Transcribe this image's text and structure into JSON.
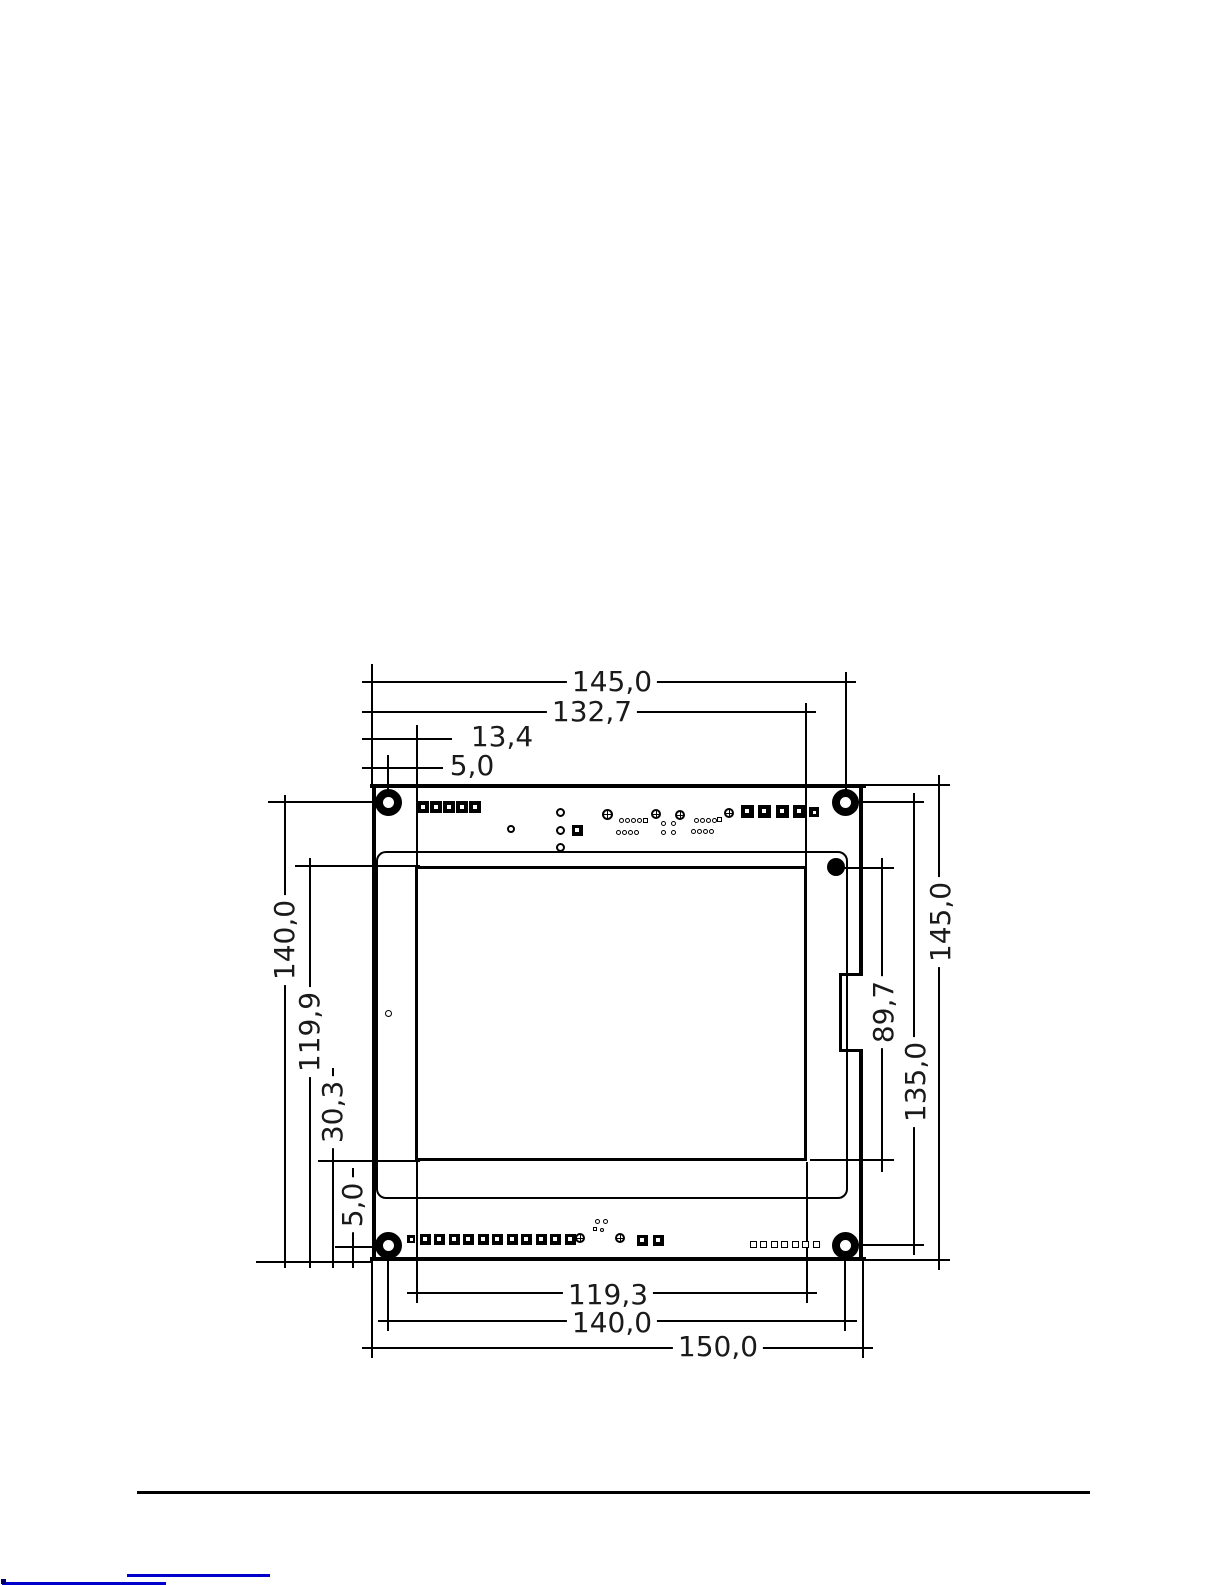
{
  "page": {
    "bg": "#ffffff",
    "ink": "#000000",
    "link_color": "#0000cc"
  },
  "diagram": {
    "type": "mechanical-dimension-drawing",
    "subject": "PCB / display module outline",
    "units": "mm",
    "dims": [
      {
        "id": "top-overall",
        "label": "145,0",
        "x": 612,
        "y": 682,
        "rot": 0
      },
      {
        "id": "top-active-right",
        "label": "132,7",
        "x": 592,
        "y": 712,
        "rot": 0
      },
      {
        "id": "top-active-left",
        "label": "13,4",
        "x": 502,
        "y": 737,
        "rot": 0
      },
      {
        "id": "top-hole-offset",
        "label": "5,0",
        "x": 472,
        "y": 766,
        "rot": 0
      },
      {
        "id": "left-hole-span",
        "label": "140,0",
        "x": 285,
        "y": 940,
        "rot": -90
      },
      {
        "id": "left-active-top",
        "label": "119,9",
        "x": 310,
        "y": 1032,
        "rot": -90
      },
      {
        "id": "left-active-bottom",
        "label": "30,3",
        "x": 333,
        "y": 1112,
        "rot": -90
      },
      {
        "id": "left-hole-offset",
        "label": "5,0",
        "x": 353,
        "y": 1205,
        "rot": -90
      },
      {
        "id": "right-active-height",
        "label": "89,7",
        "x": 884,
        "y": 1012,
        "rot": -90
      },
      {
        "id": "right-hole-span",
        "label": "135,0",
        "x": 916,
        "y": 1082,
        "rot": -90
      },
      {
        "id": "right-board-height",
        "label": "145,0",
        "x": 941,
        "y": 922,
        "rot": -90
      },
      {
        "id": "bottom-pad-span",
        "label": "119,3",
        "x": 608,
        "y": 1295,
        "rot": 0
      },
      {
        "id": "bottom-hole-span",
        "label": "140,0",
        "x": 612,
        "y": 1323,
        "rot": 0
      },
      {
        "id": "bottom-board-width",
        "label": "150,0",
        "x": 718,
        "y": 1347,
        "rot": 0
      }
    ],
    "shapes": [
      {
        "t": "h",
        "n": "board-edge-top",
        "x1": 370,
        "x2": 866,
        "y": 786,
        "w": 4
      },
      {
        "t": "h",
        "n": "board-edge-bottom",
        "x1": 370,
        "x2": 866,
        "y": 1259,
        "w": 4
      },
      {
        "t": "v",
        "n": "board-edge-left",
        "x": 374,
        "y1": 784,
        "y2": 1261,
        "w": 4
      },
      {
        "t": "v",
        "n": "board-edge-right-upper",
        "x": 861,
        "y1": 784,
        "y2": 975,
        "w": 4
      },
      {
        "t": "v",
        "n": "board-edge-right-lower",
        "x": 861,
        "y1": 1049,
        "y2": 1261,
        "w": 4
      },
      {
        "t": "h",
        "n": "board-notch-top",
        "x1": 839,
        "x2": 863,
        "y": 974,
        "w": 3
      },
      {
        "t": "h",
        "n": "board-notch-bottom",
        "x1": 839,
        "x2": 863,
        "y": 1050,
        "w": 3
      },
      {
        "t": "v",
        "n": "board-notch-side",
        "x": 840,
        "y1": 973,
        "y2": 1051,
        "w": 3
      },
      {
        "t": "rrect",
        "n": "display-outline",
        "x": 376,
        "y": 851,
        "wd": 472,
        "ht": 348,
        "bw": 2,
        "r": 10
      },
      {
        "t": "rect",
        "n": "active-area-outline",
        "x": 415,
        "y": 866,
        "wd": 392,
        "ht": 295,
        "bw": 3
      },
      {
        "t": "v",
        "n": "ext-line",
        "x": 372,
        "y1": 664,
        "y2": 785
      },
      {
        "t": "v",
        "n": "ext-line",
        "x": 388,
        "y1": 755,
        "y2": 800
      },
      {
        "t": "v",
        "n": "ext-line",
        "x": 417,
        "y1": 725,
        "y2": 866
      },
      {
        "t": "v",
        "n": "ext-line",
        "x": 806,
        "y1": 703,
        "y2": 866
      },
      {
        "t": "v",
        "n": "ext-line",
        "x": 846,
        "y1": 672,
        "y2": 800
      },
      {
        "t": "h",
        "n": "dim-line-top-145",
        "x1": 362,
        "x2": 856,
        "y": 682
      },
      {
        "t": "h",
        "n": "dim-line-top-132-7",
        "x1": 362,
        "x2": 816,
        "y": 712
      },
      {
        "t": "h",
        "n": "dim-line-top-13-4",
        "x1": 362,
        "x2": 452,
        "y": 739
      },
      {
        "t": "h",
        "n": "dim-line-top-5-0",
        "x1": 362,
        "x2": 443,
        "y": 768
      },
      {
        "t": "h",
        "n": "ext-line",
        "x1": 268,
        "x2": 386,
        "y": 802
      },
      {
        "t": "h",
        "n": "ext-line",
        "x1": 295,
        "x2": 420,
        "y": 866
      },
      {
        "t": "h",
        "n": "ext-line",
        "x1": 318,
        "x2": 420,
        "y": 1161
      },
      {
        "t": "h",
        "n": "ext-line",
        "x1": 335,
        "x2": 389,
        "y": 1247
      },
      {
        "t": "h",
        "n": "ext-line",
        "x1": 256,
        "x2": 372,
        "y": 1262
      },
      {
        "t": "v",
        "n": "dim-line-left-140",
        "x": 285,
        "y1": 795,
        "y2": 1268
      },
      {
        "t": "v",
        "n": "dim-line-left-119-9",
        "x": 310,
        "y1": 858,
        "y2": 1268
      },
      {
        "t": "v",
        "n": "dim-line-left-30-3",
        "x": 333,
        "y1": 1068,
        "y2": 1268
      },
      {
        "t": "v",
        "n": "dim-line-left-5-0",
        "x": 353,
        "y1": 1168,
        "y2": 1268
      },
      {
        "t": "h",
        "n": "ext-line",
        "x1": 852,
        "x2": 924,
        "y": 802
      },
      {
        "t": "h",
        "n": "ext-line",
        "x1": 843,
        "x2": 894,
        "y": 868
      },
      {
        "t": "h",
        "n": "ext-line",
        "x1": 810,
        "x2": 894,
        "y": 1160
      },
      {
        "t": "h",
        "n": "ext-line",
        "x1": 852,
        "x2": 924,
        "y": 1245
      },
      {
        "t": "h",
        "n": "ext-line",
        "x1": 866,
        "x2": 950,
        "y": 785
      },
      {
        "t": "h",
        "n": "ext-line",
        "x1": 866,
        "x2": 950,
        "y": 1260
      },
      {
        "t": "v",
        "n": "dim-line-right-89-7",
        "x": 882,
        "y1": 858,
        "y2": 1172
      },
      {
        "t": "v",
        "n": "dim-line-right-135",
        "x": 914,
        "y1": 793,
        "y2": 1255
      },
      {
        "t": "v",
        "n": "dim-line-right-145",
        "x": 939,
        "y1": 775,
        "y2": 1270
      },
      {
        "t": "v",
        "n": "ext-line",
        "x": 417,
        "y1": 1162,
        "y2": 1303
      },
      {
        "t": "v",
        "n": "ext-line",
        "x": 807,
        "y1": 1162,
        "y2": 1303
      },
      {
        "t": "v",
        "n": "ext-line",
        "x": 388,
        "y1": 1248,
        "y2": 1331
      },
      {
        "t": "v",
        "n": "ext-line",
        "x": 845,
        "y1": 1248,
        "y2": 1331
      },
      {
        "t": "v",
        "n": "ext-line",
        "x": 372,
        "y1": 1261,
        "y2": 1358
      },
      {
        "t": "v",
        "n": "ext-line",
        "x": 863,
        "y1": 1261,
        "y2": 1358
      },
      {
        "t": "h",
        "n": "dim-line-bottom-119-3",
        "x1": 407,
        "x2": 817,
        "y": 1293
      },
      {
        "t": "h",
        "n": "dim-line-bottom-140",
        "x1": 378,
        "x2": 857,
        "y": 1321
      },
      {
        "t": "h",
        "n": "dim-line-bottom-150",
        "x1": 362,
        "x2": 873,
        "y": 1348
      },
      {
        "t": "ring",
        "n": "mounting-hole",
        "cx": 388,
        "cy": 802,
        "d": 27,
        "bw": 8
      },
      {
        "t": "ring",
        "n": "mounting-hole",
        "cx": 845,
        "cy": 802,
        "d": 27,
        "bw": 8
      },
      {
        "t": "ring",
        "n": "mounting-hole",
        "cx": 388,
        "cy": 1245,
        "d": 27,
        "bw": 8
      },
      {
        "t": "ring",
        "n": "mounting-hole",
        "cx": 845,
        "cy": 1245,
        "d": 27,
        "bw": 8
      },
      {
        "t": "dot",
        "n": "alignment-dot",
        "cx": 836,
        "cy": 867,
        "d": 18
      },
      {
        "t": "circ",
        "n": "small-hole",
        "cx": 388,
        "cy": 1013,
        "d": 7,
        "bw": 1.5
      },
      {
        "t": "sqpad",
        "n": "pad-square",
        "cx": 423,
        "cy": 807,
        "s": 12
      },
      {
        "t": "sqpad",
        "n": "pad-square",
        "cx": 436,
        "cy": 807,
        "s": 12
      },
      {
        "t": "sqpad",
        "n": "pad-square",
        "cx": 449,
        "cy": 807,
        "s": 12
      },
      {
        "t": "sqpad",
        "n": "pad-square",
        "cx": 462,
        "cy": 807,
        "s": 12
      },
      {
        "t": "sqpad",
        "n": "pad-square",
        "cx": 475,
        "cy": 807,
        "s": 12
      },
      {
        "t": "circ",
        "n": "pad-round",
        "cx": 511,
        "cy": 829,
        "d": 8,
        "bw": 2
      },
      {
        "t": "circ",
        "n": "pad-round",
        "cx": 560,
        "cy": 812,
        "d": 9,
        "bw": 2
      },
      {
        "t": "circ",
        "n": "pad-round",
        "cx": 560,
        "cy": 830,
        "d": 9,
        "bw": 2
      },
      {
        "t": "circ",
        "n": "pad-round",
        "cx": 560,
        "cy": 847,
        "d": 9,
        "bw": 2
      },
      {
        "t": "sqpad",
        "n": "pad-square",
        "cx": 577,
        "cy": 830,
        "s": 11
      },
      {
        "t": "circx",
        "n": "pad-crosshair",
        "cx": 607,
        "cy": 814,
        "d": 11
      },
      {
        "t": "circ",
        "n": "via",
        "cx": 621,
        "cy": 820,
        "d": 5,
        "bw": 1.2
      },
      {
        "t": "circ",
        "n": "via",
        "cx": 627,
        "cy": 820,
        "d": 5,
        "bw": 1.2
      },
      {
        "t": "circ",
        "n": "via",
        "cx": 633,
        "cy": 820,
        "d": 5,
        "bw": 1.2
      },
      {
        "t": "circ",
        "n": "via",
        "cx": 639,
        "cy": 820,
        "d": 5,
        "bw": 1.2
      },
      {
        "t": "sq",
        "n": "via-square",
        "cx": 645,
        "cy": 820,
        "s": 5
      },
      {
        "t": "circ",
        "n": "via",
        "cx": 618,
        "cy": 832,
        "d": 5,
        "bw": 1.2
      },
      {
        "t": "circ",
        "n": "via",
        "cx": 624,
        "cy": 832,
        "d": 5,
        "bw": 1.2
      },
      {
        "t": "circ",
        "n": "via",
        "cx": 630,
        "cy": 832,
        "d": 5,
        "bw": 1.2
      },
      {
        "t": "circ",
        "n": "via",
        "cx": 636,
        "cy": 832,
        "d": 5,
        "bw": 1.2
      },
      {
        "t": "circx",
        "n": "pad-crosshair",
        "cx": 656,
        "cy": 814,
        "d": 10
      },
      {
        "t": "circ",
        "n": "via",
        "cx": 663,
        "cy": 823,
        "d": 5,
        "bw": 1.2
      },
      {
        "t": "circ",
        "n": "via",
        "cx": 673,
        "cy": 823,
        "d": 5,
        "bw": 1.2
      },
      {
        "t": "circ",
        "n": "via",
        "cx": 663,
        "cy": 832,
        "d": 5,
        "bw": 1.2
      },
      {
        "t": "circ",
        "n": "via",
        "cx": 673,
        "cy": 832,
        "d": 5,
        "bw": 1.2
      },
      {
        "t": "circx",
        "n": "pad-crosshair",
        "cx": 680,
        "cy": 815,
        "d": 10
      },
      {
        "t": "circ",
        "n": "via",
        "cx": 696,
        "cy": 820,
        "d": 5,
        "bw": 1.2
      },
      {
        "t": "circ",
        "n": "via",
        "cx": 702,
        "cy": 820,
        "d": 5,
        "bw": 1.2
      },
      {
        "t": "circ",
        "n": "via",
        "cx": 708,
        "cy": 820,
        "d": 5,
        "bw": 1.2
      },
      {
        "t": "circ",
        "n": "via",
        "cx": 714,
        "cy": 820,
        "d": 5,
        "bw": 1.2
      },
      {
        "t": "sq",
        "n": "via-square",
        "cx": 719,
        "cy": 819,
        "s": 5
      },
      {
        "t": "circ",
        "n": "via",
        "cx": 693,
        "cy": 831,
        "d": 5,
        "bw": 1.2
      },
      {
        "t": "circ",
        "n": "via",
        "cx": 699,
        "cy": 831,
        "d": 5,
        "bw": 1.2
      },
      {
        "t": "circ",
        "n": "via",
        "cx": 705,
        "cy": 831,
        "d": 5,
        "bw": 1.2
      },
      {
        "t": "circ",
        "n": "via",
        "cx": 711,
        "cy": 831,
        "d": 5,
        "bw": 1.2
      },
      {
        "t": "circx",
        "n": "pad-crosshair",
        "cx": 729,
        "cy": 813,
        "d": 10
      },
      {
        "t": "sqpad",
        "n": "pad-square",
        "cx": 747,
        "cy": 811,
        "s": 13
      },
      {
        "t": "sqpad",
        "n": "pad-square",
        "cx": 764,
        "cy": 811,
        "s": 13
      },
      {
        "t": "sqpad",
        "n": "pad-square",
        "cx": 782,
        "cy": 811,
        "s": 13
      },
      {
        "t": "sqpad",
        "n": "pad-square",
        "cx": 799,
        "cy": 811,
        "s": 13
      },
      {
        "t": "sqpad",
        "n": "pad-square",
        "cx": 814,
        "cy": 812,
        "s": 10
      },
      {
        "t": "sqpad",
        "n": "pad-square",
        "cx": 411,
        "cy": 1239,
        "s": 8
      },
      {
        "t": "sqpad",
        "n": "pad-square",
        "cx": 425,
        "cy": 1239,
        "s": 11
      },
      {
        "t": "sqpad",
        "n": "pad-square",
        "cx": 439,
        "cy": 1239,
        "s": 11
      },
      {
        "t": "sqpad",
        "n": "pad-square",
        "cx": 454,
        "cy": 1239,
        "s": 11
      },
      {
        "t": "sqpad",
        "n": "pad-square",
        "cx": 468,
        "cy": 1239,
        "s": 11
      },
      {
        "t": "sqpad",
        "n": "pad-square",
        "cx": 483,
        "cy": 1239,
        "s": 11
      },
      {
        "t": "sqpad",
        "n": "pad-square",
        "cx": 497,
        "cy": 1239,
        "s": 11
      },
      {
        "t": "sqpad",
        "n": "pad-square",
        "cx": 512,
        "cy": 1239,
        "s": 11
      },
      {
        "t": "sqpad",
        "n": "pad-square",
        "cx": 526,
        "cy": 1239,
        "s": 11
      },
      {
        "t": "sqpad",
        "n": "pad-square",
        "cx": 541,
        "cy": 1239,
        "s": 11
      },
      {
        "t": "sqpad",
        "n": "pad-square",
        "cx": 555,
        "cy": 1239,
        "s": 11
      },
      {
        "t": "sqpad",
        "n": "pad-square",
        "cx": 570,
        "cy": 1239,
        "s": 11
      },
      {
        "t": "circx",
        "n": "pad-crosshair",
        "cx": 580,
        "cy": 1238,
        "d": 10
      },
      {
        "t": "circ",
        "n": "via",
        "cx": 597,
        "cy": 1221,
        "d": 5,
        "bw": 1.2
      },
      {
        "t": "circ",
        "n": "via",
        "cx": 605,
        "cy": 1221,
        "d": 5,
        "bw": 1.2
      },
      {
        "t": "sq",
        "n": "via-square",
        "cx": 595,
        "cy": 1229,
        "s": 4
      },
      {
        "t": "circ",
        "n": "via",
        "cx": 602,
        "cy": 1230,
        "d": 4,
        "bw": 1.2
      },
      {
        "t": "circx",
        "n": "pad-crosshair",
        "cx": 620,
        "cy": 1238,
        "d": 10
      },
      {
        "t": "sqpad",
        "n": "pad-square",
        "cx": 642,
        "cy": 1240,
        "s": 11
      },
      {
        "t": "sqpad",
        "n": "pad-square",
        "cx": 658,
        "cy": 1240,
        "s": 11
      },
      {
        "t": "sq",
        "n": "pad-square-small",
        "cx": 753,
        "cy": 1244,
        "s": 7
      },
      {
        "t": "sq",
        "n": "pad-square-small",
        "cx": 763,
        "cy": 1244,
        "s": 7
      },
      {
        "t": "sq",
        "n": "pad-square-small",
        "cx": 774,
        "cy": 1244,
        "s": 7
      },
      {
        "t": "sq",
        "n": "pad-square-small",
        "cx": 784,
        "cy": 1244,
        "s": 7
      },
      {
        "t": "sq",
        "n": "pad-square-small",
        "cx": 795,
        "cy": 1244,
        "s": 7
      },
      {
        "t": "sq",
        "n": "pad-square-small",
        "cx": 805,
        "cy": 1244,
        "s": 7
      },
      {
        "t": "sq",
        "n": "pad-square-small",
        "cx": 816,
        "cy": 1244,
        "s": 7
      },
      {
        "t": "h",
        "n": "footer-divider",
        "x1": 137,
        "x2": 1090,
        "y": 1492,
        "w": 3
      },
      {
        "t": "h",
        "n": "footer-link-underline",
        "x1": 127,
        "x2": 270,
        "y": 1575,
        "w": 3,
        "c": "#0000cc",
        "i": true
      },
      {
        "t": "h",
        "n": "footer-link-cut-text",
        "x1": 2,
        "x2": 166,
        "y": 1583,
        "w": 3,
        "c": "#0000cc",
        "i": true
      },
      {
        "t": "fill",
        "n": "footer-link-cut-mark",
        "x": 1,
        "y": 1579,
        "wd": 5,
        "ht": 5,
        "c": "#000066"
      }
    ]
  }
}
